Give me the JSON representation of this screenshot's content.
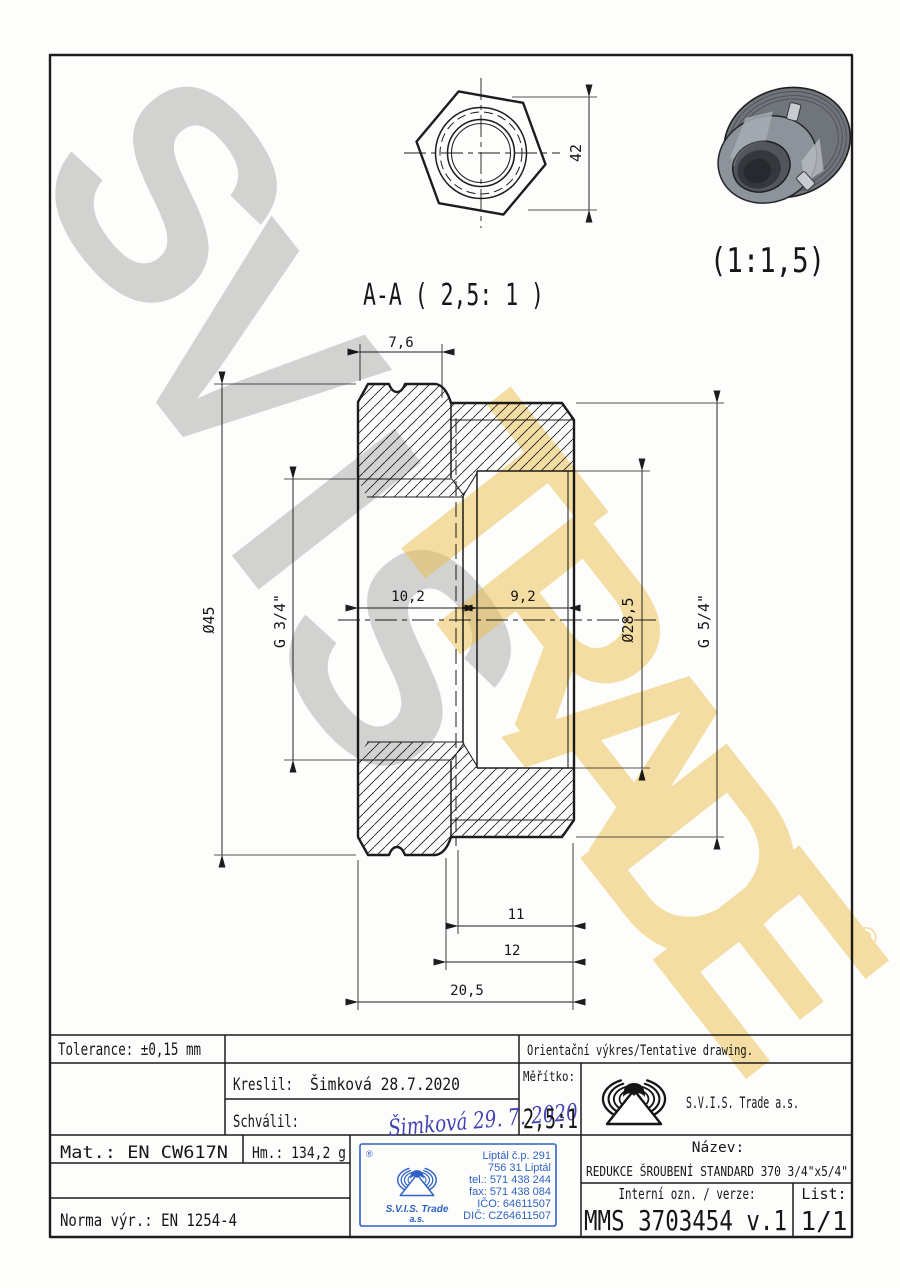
{
  "watermark": {
    "gray_letters": [
      "S",
      "V",
      "I",
      "S"
    ],
    "gold_letters": [
      "T",
      "R",
      "A",
      "D",
      "E"
    ],
    "registered": "®"
  },
  "drawing": {
    "section_label": "A-A ( 2,5: 1 )",
    "photo_scale_label": "(1:1,5)",
    "dimensions": {
      "across_flats": "42",
      "hex_width": "7,6",
      "outer_dia": "Ø45",
      "thread_left": "G 3/4\"",
      "len_left": "10,2",
      "len_right": "9,2",
      "bore_dia": "Ø28,5",
      "thread_right": "G 5/4\"",
      "len_11": "11",
      "len_12": "12",
      "len_total": "20,5"
    }
  },
  "title_block": {
    "tolerance": "Tolerance: ±0,15 mm",
    "orientation_note": "Orientační výkres/Tentative drawing.",
    "kreslil_label": "Kreslil:",
    "kreslil_value": "Šimková 28.7.2020",
    "schvalil_label": "Schválil:",
    "schvalil_signature": "Šimková 29. 7. 2020",
    "meritko_label": "Měřítko:",
    "meritko_value": "2,5:1",
    "company_name": "S.V.I.S. Trade a.s.",
    "material": "Mat.: EN CW617N",
    "weight": "Hm.: 134,2 g",
    "norm": "Norma výr.: EN 1254-4",
    "nazev_label": "Název:",
    "nazev_value": "REDUKCE ŠROUBENÍ STANDARD 370 3/4\"x5/4\"",
    "interni_label": "Interní ozn. / verze:",
    "interni_value": "MMS 3703454 v.1",
    "list_label": "List:",
    "list_value": "1/1"
  },
  "stamp": {
    "registered": "®",
    "address_lines": [
      "Liptál č.p. 291",
      "756 31 Liptál",
      "tel.: 571 438 244",
      "fax: 571 438 084",
      "IČO: 64611507",
      "DIČ: CZ64611507"
    ],
    "brand": "S.V.I.S. Trade",
    "brand_suffix": "a.s."
  },
  "colors": {
    "line": "#1c1c1c",
    "stamp_blue": "#2f62c5",
    "signature_blue": "#4343b5",
    "watermark_gray": "#9a9a9a",
    "watermark_gold": "#eec04c"
  }
}
